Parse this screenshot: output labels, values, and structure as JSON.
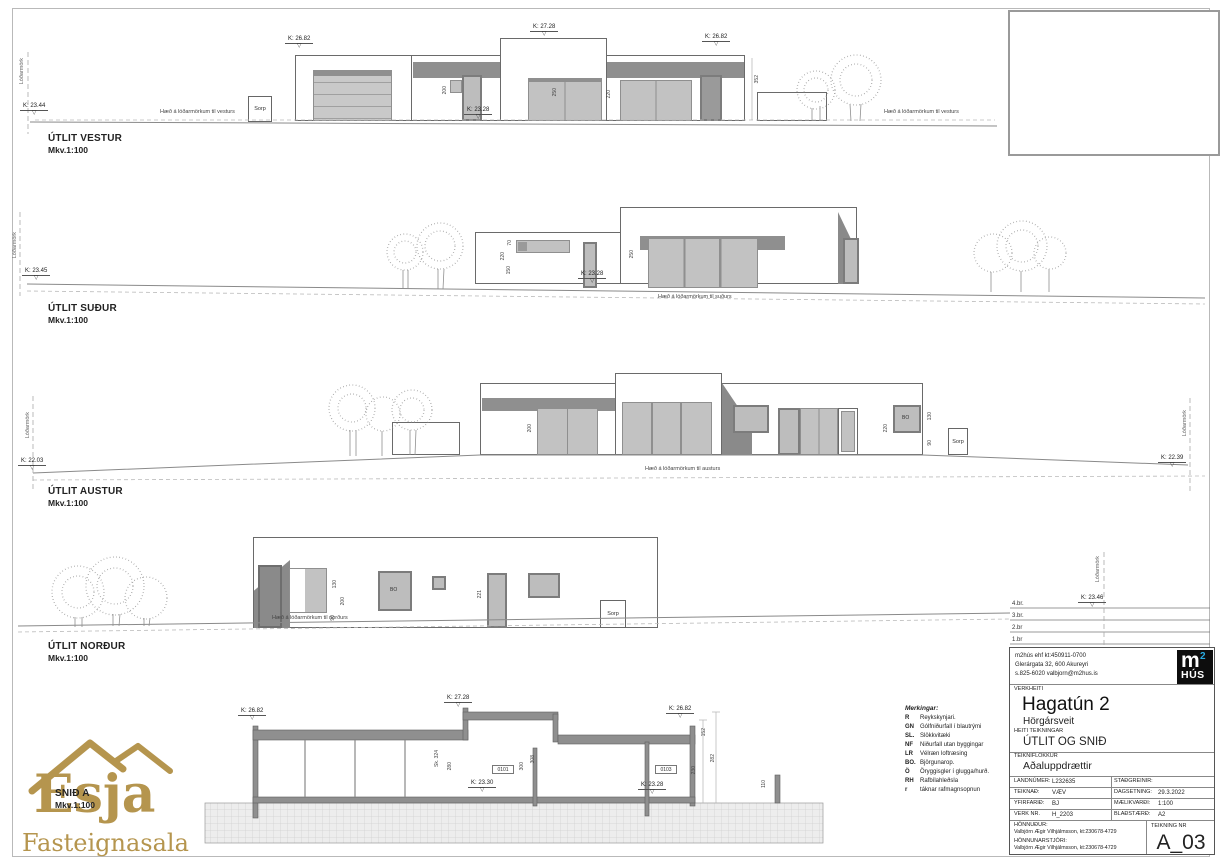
{
  "colors": {
    "gold": "#b5954e",
    "logo_blue": "#29abe2",
    "glazing_gray": "#c2c2c2",
    "band_gray": "#8f8f8f"
  },
  "icons": {
    "level_triangle": "▽"
  },
  "elev_vestur": {
    "title": "ÚTLIT VESTUR",
    "scale": "Mkv.1:100",
    "lodarmork": "Lóðarmörk",
    "k_left": "K: 23.44",
    "k_parapet_left": "K: 26.82",
    "k_tower": "K: 27.28",
    "k_parapet_right": "K: 26.82",
    "k_door": "K: 23.28",
    "sorp": "Sorp",
    "ground_note_left": "Hæð á lóðarmörkum til vesturs",
    "ground_note_right": "Hæð á lóðarmörkum til vesturs"
  },
  "elev_sudur": {
    "title": "ÚTLIT SUÐUR",
    "scale": "Mkv.1:100",
    "lodarmork": "Lóðarmörk",
    "k_left": "K: 23.45",
    "k_door": "K: 23.28",
    "ground_note": "Hæð á lóðarmörkum til suðurs"
  },
  "elev_austur": {
    "title": "ÚTLIT AUSTUR",
    "scale": "Mkv.1:100",
    "lodarmork_left": "Lóðarmörk",
    "lodarmork_right": "Lóðarmörk",
    "k_left": "K: 22.03",
    "k_right": "K: 22.39",
    "sorp": "Sorp",
    "bo": "BO",
    "ground_note": "Hæð á lóðarmörkum til austurs"
  },
  "elev_nordur": {
    "title": "ÚTLIT NORÐUR",
    "scale": "Mkv.1:100",
    "lodarmork": "Lóðarmörk",
    "k_right": "K: 23.46",
    "sorp": "Sorp",
    "bo": "BO",
    "ground_note": "Hæð á lóðarmörkum til norðurs",
    "revisions": [
      {
        "label": "4.br."
      },
      {
        "label": "3.br."
      },
      {
        "label": "2.br"
      },
      {
        "label": "1.br"
      }
    ]
  },
  "section": {
    "title": "SNIÐ A",
    "scale": "Mkv.1:100",
    "k_parapet_left": "K: 26.82",
    "k_tower": "K: 27.28",
    "k_parapet_right": "K: 26.82",
    "k_floor_left": "K: 23.30",
    "k_floor_right": "K: 23.28",
    "room_left": "0101",
    "room_right": "0103"
  },
  "dims": {
    "d50": "50",
    "d70": "70",
    "d90": "90",
    "d100": "100",
    "d110": "110",
    "d130": "130",
    "d150": "150",
    "d152": "152",
    "d191": "191",
    "d200": "200",
    "d220": "220",
    "d221": "221",
    "d230": "230",
    "d250": "250",
    "d280": "280",
    "d282": "282",
    "d300": "300",
    "d308": "308",
    "d352": "352",
    "sk324": "Sk. 324"
  },
  "legend": {
    "title": "Merkingar:",
    "items": [
      {
        "code": "R",
        "desc": "Reykskynjari."
      },
      {
        "code": "GN",
        "desc": "Gólfniðurfall í blautrými"
      },
      {
        "code": "SL.",
        "desc": "Slökkvitæki"
      },
      {
        "code": "NF",
        "desc": "Niðurfall utan byggingar"
      },
      {
        "code": "LR",
        "desc": "Vélræn loftræsing"
      },
      {
        "code": "BO.",
        "desc": "Björgunarop."
      },
      {
        "code": "Ö",
        "desc": "Öryggisgler í glugga/hurð."
      },
      {
        "code": "RH",
        "desc": "Rafbílahleðsla"
      },
      {
        "code": "r",
        "desc": "táknar rafmagnsopnun"
      }
    ]
  },
  "titleblock": {
    "company_line1": "m2hús ehf    kt:450911-0700",
    "company_line2": "Glerárgata 32, 600 Akureyri",
    "company_line3": "s.825-6020   valbjorn@m2hus.is",
    "verkheiti_label": "VERKHEITI",
    "project": "Hagatún 2",
    "municipality": "Hörgársveit",
    "heiti_label": "HEITI TEIKNINGAR",
    "drawing_title": "ÚTLIT OG SNIÐ",
    "flokkur_label": "TEIKNIFLOKKUR",
    "flokkur": "Aðaluppdrættir",
    "fields": {
      "landnumer_label": "LANDNÚMER:",
      "landnumer": "L232635",
      "stadgreinir_label": "STAÐGREINIR:",
      "stadgreinir": "",
      "teiknad_label": "TEIKNAÐ:",
      "teiknad": "VÆV",
      "dagsetning_label": "DAGSETNING:",
      "dagsetning": "29.3.2022",
      "yfirfarid_label": "YFIRFARIÐ:",
      "yfirfarid": "BJ",
      "maelikvardi_label": "MÆLIKVARÐI:",
      "maelikvardi": "1:100",
      "verknr_label": "VERK NR.",
      "verknr": "H_2203",
      "bladstaerd_label": "BLAÐSTÆRÐ:",
      "bladstaerd": "A2"
    },
    "honnudur_label": "HÖNNUÐUR:",
    "honnudur": "Valbjörn Ægir Vilhjálmsson, kt:230678-4729",
    "honnunarstjori_label": "HÖNNUNARSTJÓRI:",
    "honnunarstjori": "Valbjörn Ægir Vilhjálmsson, kt:230678-4729",
    "teikning_nr_label": "TEIKNING NR",
    "teikning_nr": "A_03"
  },
  "m2hus_logo": {
    "m": "m",
    "two": "2",
    "hus": "HÚS"
  },
  "watermark": {
    "name": "Esja",
    "subtitle": "Fasteignasala"
  }
}
